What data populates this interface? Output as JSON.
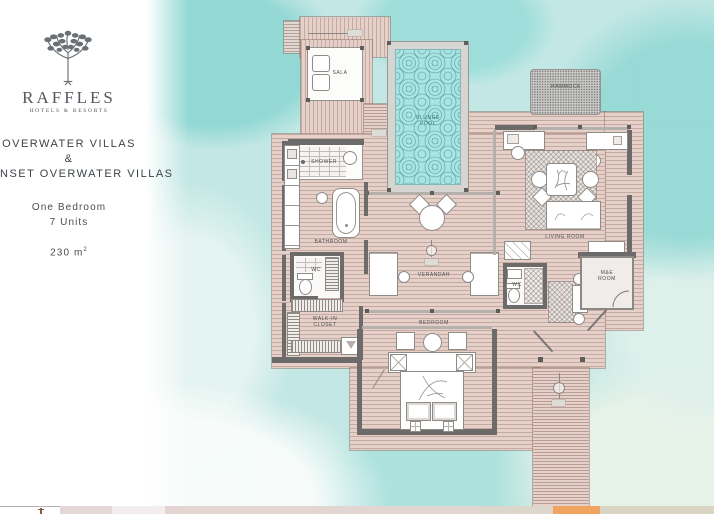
{
  "panel": {
    "brand": "RAFFLES",
    "brand_sub": "HOTELS & RESORTS",
    "title_line1": "OVERWATER VILLAS",
    "title_amp": "&",
    "title_line2": "NSET OVERWATER VILLAS",
    "spec_line1": "One Bedroom",
    "spec_line2": "7 Units",
    "area_value": "230 m",
    "area_sup": "2"
  },
  "plan": {
    "rooms": {
      "sala": "SALA",
      "plunge_pool_line1": "PLUNGE",
      "plunge_pool_line2": "POOL",
      "hammock": "HAMMOCK",
      "shower": "SHOWER",
      "bathroom": "BATHROOM",
      "wc_left": "WC",
      "verandah": "VERANDAH",
      "living_room": "LIVING ROOM",
      "wc_right": "WC",
      "me_room_line1": "M&E",
      "me_room_line2": "ROOM",
      "walkin_line1": "WALK-IN",
      "walkin_line2": "CLOSET",
      "bedroom": "BEDROOM"
    }
  },
  "colors": {
    "water": "#c2e7e4",
    "water_bright": "#92d8d4",
    "deck": "#e6d1ca",
    "wall": "#6d6b69",
    "pool": "#a8e4e3",
    "pool_swirl": "#2f7d80",
    "strip_orange": "#f1a360",
    "text_dark": "#3d4348"
  }
}
